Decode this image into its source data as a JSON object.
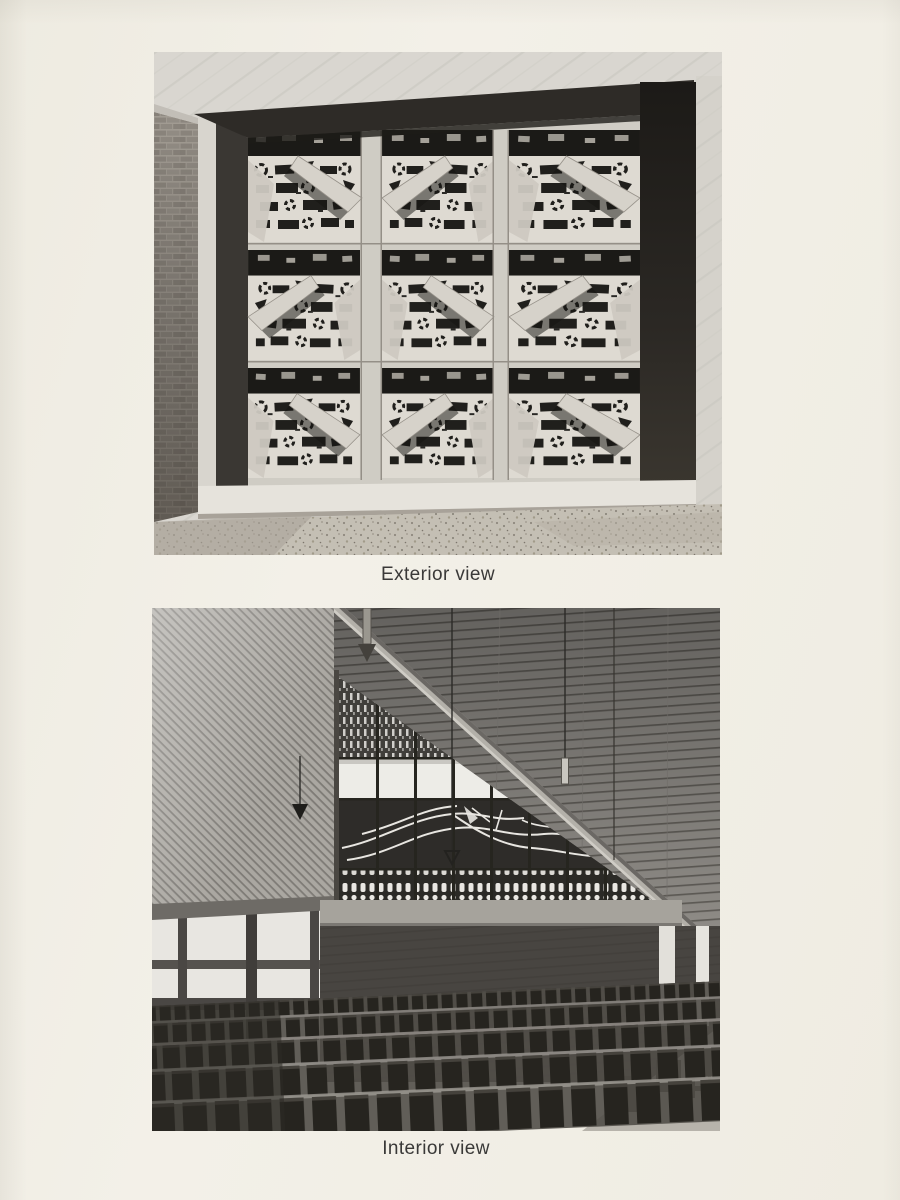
{
  "page": {
    "kind": "printed book page with two photographs",
    "background_color": "#f1eee5",
    "caption_color": "#3a3938"
  },
  "figures": [
    {
      "caption": "Exterior view",
      "description": "Black-and-white photograph of a sculptural perforated concrete window screen, nine panels in a three-by-three grid, recessed in a light marble wall with a brick pier at left and gravel ground below"
    },
    {
      "caption": "Interior view",
      "description": "Black-and-white photograph of a church interior: sloping slatted ceiling, diagonal-boarded side wall, triangular stained-glass clerestory window over a dark brick wall, and rows of dark wooden chairs"
    }
  ],
  "palette": {
    "photo_highlight": "#e9e6df",
    "photo_midgray": "#9a968f",
    "photo_shadow": "#26241f",
    "paper_cream": "#f1eee5"
  }
}
